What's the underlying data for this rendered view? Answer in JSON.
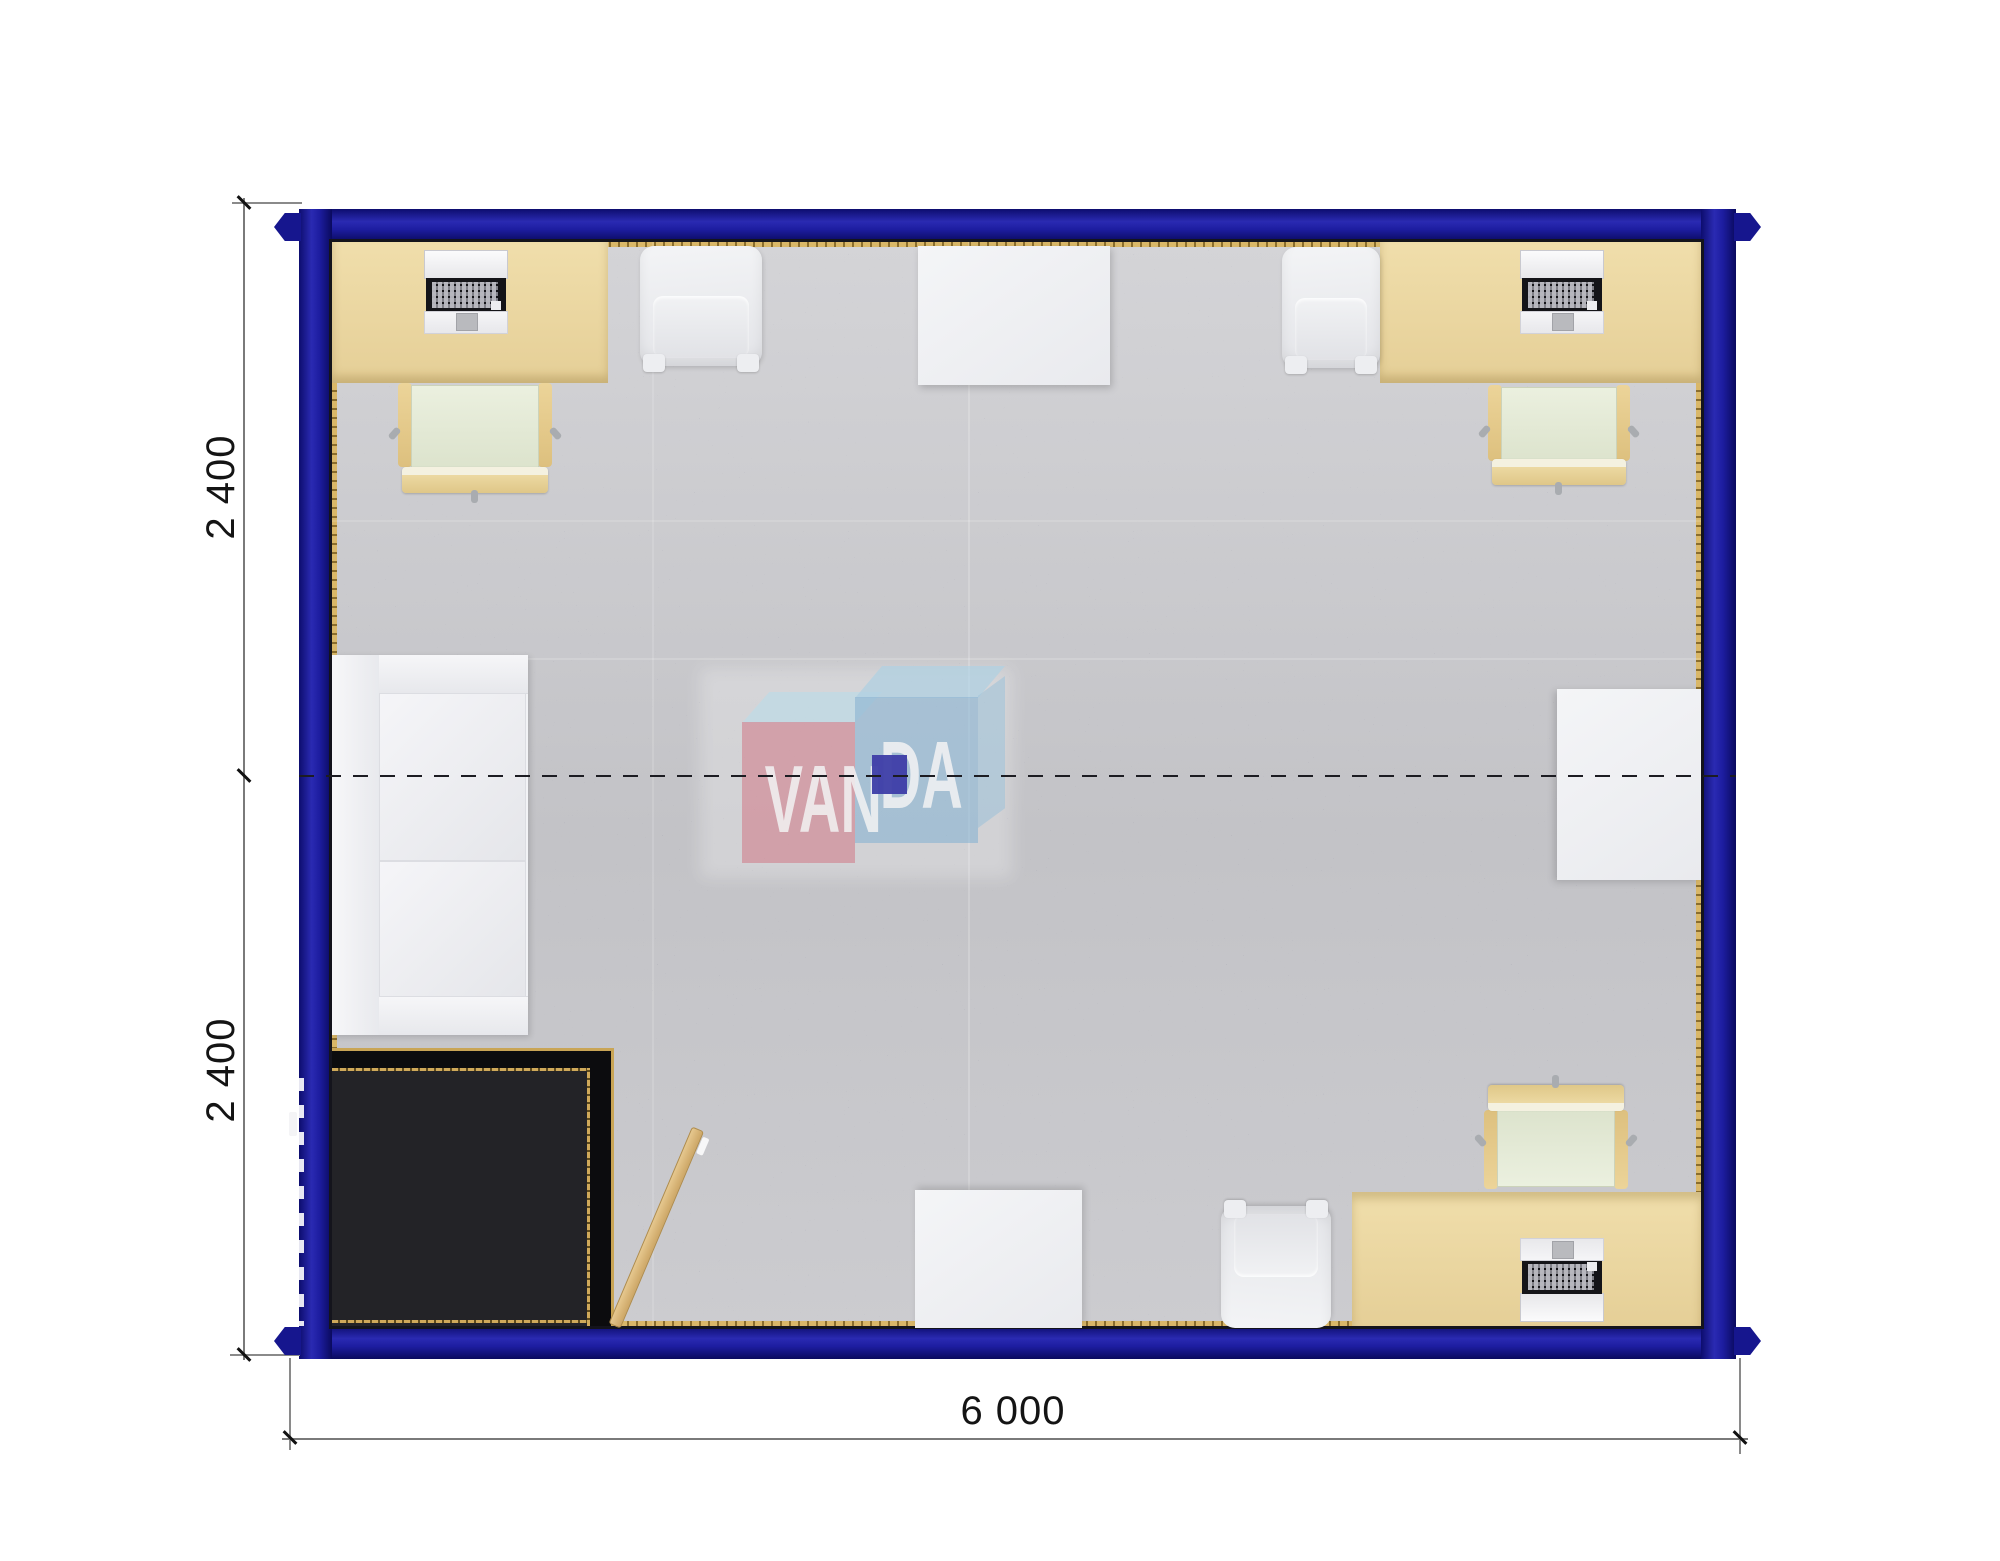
{
  "drawing": {
    "type": "container-office-floor-plan",
    "dimension_labels": {
      "left_top": "2 400",
      "left_bottom": "2 400",
      "bottom": "6 000"
    },
    "watermark": {
      "brand": "VANDA",
      "text_left": "VAN",
      "text_right": "DA"
    },
    "colors": {
      "wall": "#1b1b9c",
      "carpet": "#c9c9cd",
      "vestibule_floor": "#7d7d81",
      "desk": "#ead7a4",
      "trim_gold": "#c9a556",
      "watermark_pink": "#d67e8c",
      "watermark_blue": "#80b2d4",
      "dimension_text": "#141414"
    },
    "furniture": [
      "desk-with-computer-top-left",
      "desk-with-computer-top-right",
      "desk-with-computer-bottom-right",
      "office-chair-top-left",
      "office-chair-top-right",
      "office-chair-bottom-right",
      "armchair-top-left",
      "armchair-top-right",
      "armchair-bottom",
      "table-top-center",
      "table-bottom-center",
      "table-right-wall",
      "sofa-left-wall",
      "entrance-vestibule",
      "open-door-leaf"
    ]
  }
}
